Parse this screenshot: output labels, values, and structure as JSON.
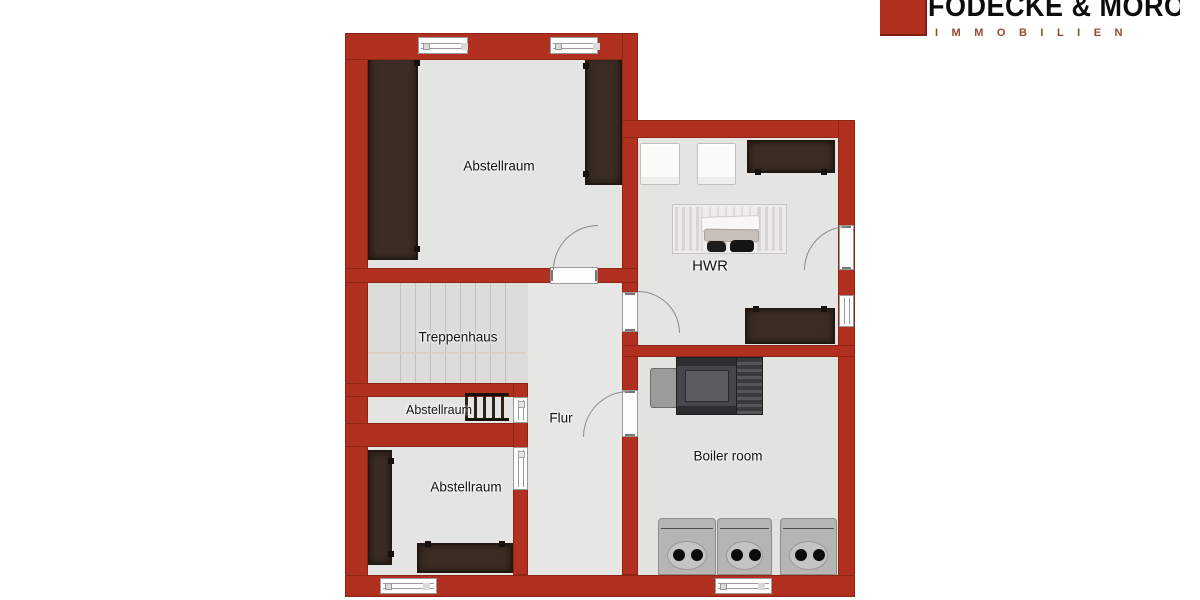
{
  "logo": {
    "company_name": "FÖDECKE & MOROLD",
    "division": "IMMOBILIEN",
    "square_color": "#b13020",
    "division_color": "#96492d"
  },
  "plan": {
    "type": "floor-plan",
    "colors": {
      "wall": "#b13020",
      "floor": "#e4e4e3",
      "stairwell_floor": "#dcdcda",
      "wood_furniture": "#3b2d23"
    },
    "rooms": [
      {
        "id": "abstellraum-top",
        "label": "Abstellraum"
      },
      {
        "id": "hwr",
        "label": "HWR"
      },
      {
        "id": "treppenhaus",
        "label": "Treppenhaus"
      },
      {
        "id": "abstellraum-narrow",
        "label": "Abstellraum"
      },
      {
        "id": "flur",
        "label": "Flur"
      },
      {
        "id": "boiler-room",
        "label": "Boiler room"
      },
      {
        "id": "abstellraum-bottom",
        "label": "Abstellraum"
      }
    ]
  }
}
